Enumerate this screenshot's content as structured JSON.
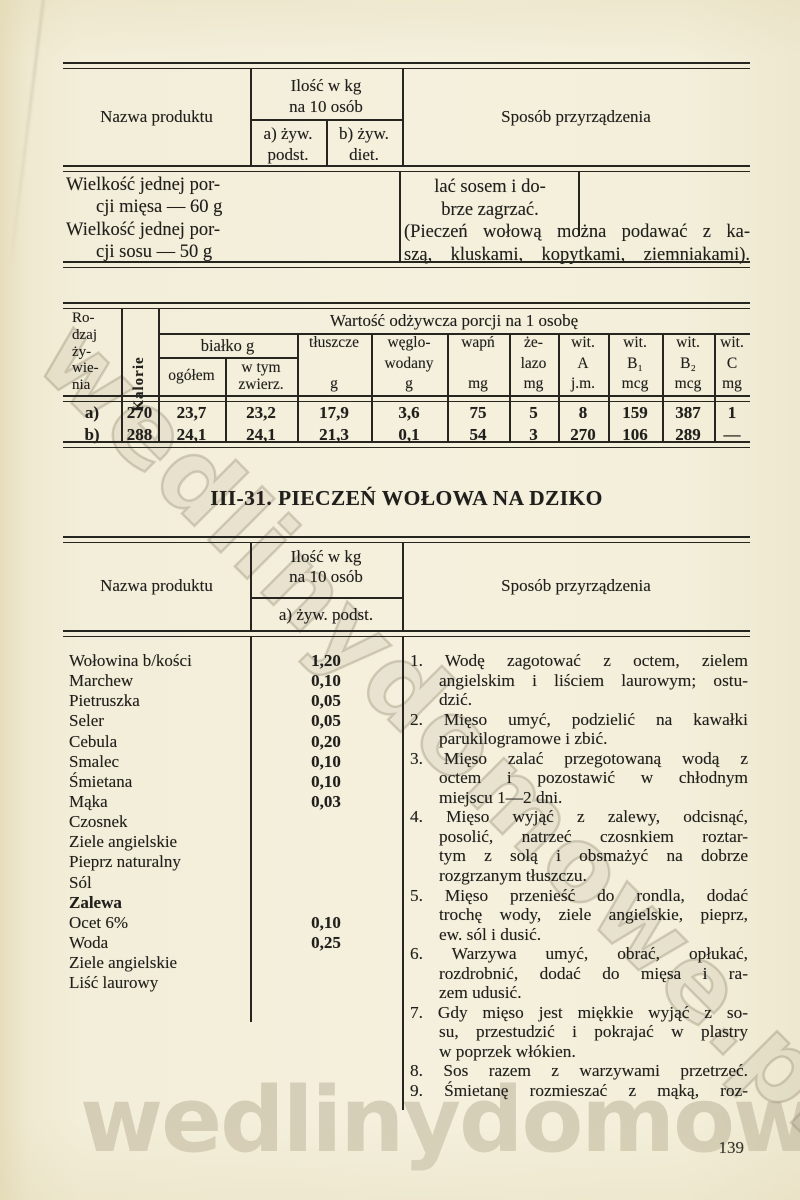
{
  "page": {
    "number": "139",
    "watermark_text": "wedlinydomowe.pl"
  },
  "colors": {
    "paper": "#f3eed9",
    "ink": "#201f1b",
    "watermark": "#8c7a5e"
  },
  "continuation_table": {
    "header": {
      "product": "Nazwa produktu",
      "qty_title_line1": "Ilość w kg",
      "qty_title_line2": "na 10 osób",
      "qty_a_line1": "a) żyw.",
      "qty_a_line2": "podst.",
      "qty_b_line1": "b) żyw.",
      "qty_b_line2": "diet.",
      "method": "Sposób przyrządzenia"
    },
    "portion_lines": [
      "Wielkość jednej por-",
      "cji mięsa — 60 g",
      "Wielkość jednej por-",
      "cji sosu — 50 g"
    ],
    "method_end_lines": [
      "lać sosem i do-",
      "brze zagrzać."
    ],
    "method_note_lines": [
      "(Pieczeń wołową można podawać z ka-",
      "szą, kluskami, kopytkami, ziemniakami)."
    ]
  },
  "nutrition_table": {
    "span_title": "Wartość odżywcza porcji na 1 osobę",
    "rodzaj_lines": [
      "Ro-",
      "dzaj",
      "ży-",
      "wie-",
      "nia"
    ],
    "kalorie": "Kalorie",
    "bialko_title": "białko g",
    "ogolem": "ogółem",
    "wtym_lines": [
      "w tym",
      "zwierz."
    ],
    "columns": {
      "tluszcze": [
        "tłuszcze",
        "g"
      ],
      "weglowodany": [
        "węglo-",
        "wodany",
        "g"
      ],
      "wapn": [
        "wapń",
        "mg"
      ],
      "zelazo": [
        "że-",
        "lazo",
        "mg"
      ],
      "wit_a": [
        "wit.",
        "A",
        "j.m."
      ],
      "wit_b1": [
        "wit.",
        "B₁",
        "mcg"
      ],
      "wit_b2": [
        "wit.",
        "B₂",
        "mcg"
      ],
      "wit_c": [
        "wit.",
        "C",
        "mg"
      ]
    },
    "rows": [
      {
        "label": "a)",
        "kalorie": "270",
        "ogolem": "23,7",
        "wtym": "23,2",
        "tluszcze": "17,9",
        "weglowodany": "3,6",
        "wapn": "75",
        "zelazo": "5",
        "wit_a": "8",
        "wit_b1": "159",
        "wit_b2": "387",
        "wit_c": "1"
      },
      {
        "label": "b)",
        "kalorie": "288",
        "ogolem": "24,1",
        "wtym": "24,1",
        "tluszcze": "21,3",
        "weglowodany": "0,1",
        "wapn": "54",
        "zelazo": "3",
        "wit_a": "270",
        "wit_b1": "106",
        "wit_b2": "289",
        "wit_c": "—"
      }
    ]
  },
  "recipe": {
    "title": "III-31. PIECZEŃ WOŁOWA NA DZIKO",
    "table_header": {
      "product": "Nazwa produktu",
      "qty_title_line1": "Ilość w kg",
      "qty_title_line2": "na 10 osób",
      "qty_a": "a) żyw. podst.",
      "method": "Sposób przyrządzenia"
    },
    "ingredients": [
      {
        "name": "Wołowina b/kości",
        "qty": "1,20"
      },
      {
        "name": "Marchew",
        "qty": "0,10"
      },
      {
        "name": "Pietruszka",
        "qty": "0,05"
      },
      {
        "name": "Seler",
        "qty": "0,05"
      },
      {
        "name": "Cebula",
        "qty": "0,20"
      },
      {
        "name": "Smalec",
        "qty": "0,10"
      },
      {
        "name": "Śmietana",
        "qty": "0,10"
      },
      {
        "name": "Mąka",
        "qty": "0,03"
      },
      {
        "name": "Czosnek",
        "qty": ""
      },
      {
        "name": "Ziele angielskie",
        "qty": ""
      },
      {
        "name": "Pieprz naturalny",
        "qty": ""
      },
      {
        "name": "Sól",
        "qty": ""
      },
      {
        "name": "Zalewa",
        "qty": ""
      },
      {
        "name": "Ocet 6%",
        "qty": "0,10"
      },
      {
        "name": "Woda",
        "qty": "0,25"
      },
      {
        "name": "Ziele angielskie",
        "qty": ""
      },
      {
        "name": "Liść laurowy",
        "qty": ""
      }
    ],
    "steps_lines": [
      "1. Wodę zagotować z octem, zielem",
      "angielskim i liściem laurowym; ostu-",
      "dzić.",
      "2. Mięso umyć, podzielić na kawałki",
      "parukilogramowe i zbić.",
      "3. Mięso zalać przegotowaną wodą z",
      "octem i pozostawić w chłodnym",
      "miejscu 1—2 dni.",
      "4. Mięso wyjąć z zalewy, odcisnąć,",
      "posolić, natrzeć czosnkiem roztar-",
      "tym z solą i obsmażyć na dobrze",
      "rozgrzanym tłuszczu.",
      "5. Mięso przenieść do rondla, dodać",
      "trochę wody, ziele angielskie, pieprz,",
      "ew. sól i dusić.",
      "6. Warzywa umyć, obrać, opłukać,",
      "rozdrobnić, dodać do mięsa i ra-",
      "zem udusić.",
      "7. Gdy mięso jest miękkie wyjąć z so-",
      "su, przestudzić i pokrajać w plastry",
      "w poprzek włókien.",
      "8. Sos razem z warzywami przetrzeć.",
      "9. Śmietanę rozmieszać z mąką, roz-"
    ]
  }
}
